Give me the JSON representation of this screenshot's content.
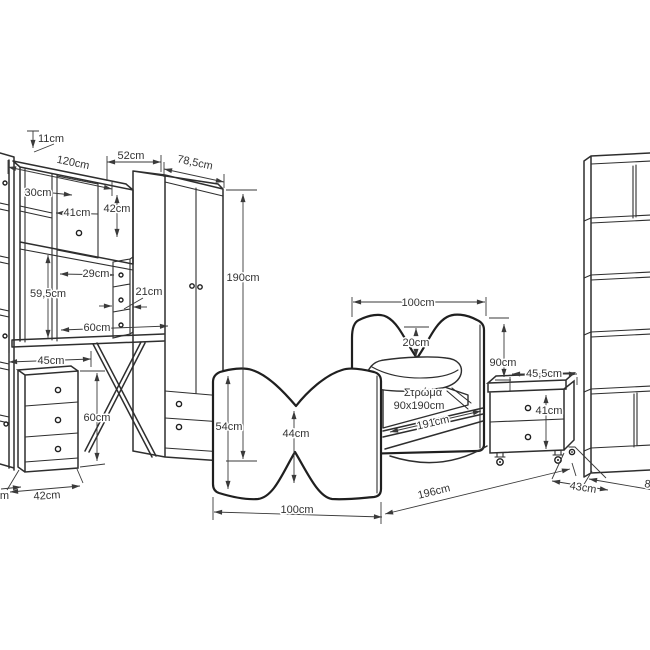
{
  "meta": {
    "background": "#ffffff",
    "line_color": "#2e2e2e",
    "text_color": "#333333"
  },
  "desk": {
    "top_depth": "11cm",
    "width": "120cm",
    "upper_section_width": "52cm",
    "hutch_left_height": "30cm",
    "hutch_door_width": "41cm",
    "hutch_right_height": "42cm",
    "open_shelf_width": "29cm",
    "small_drawers_width": "21cm",
    "open_height": "59,5cm",
    "surface_span": "60cm",
    "knee_span": "45cm",
    "pedestal_height": "60cm",
    "pedestal_width": "42cm",
    "left_edge_partial": "cm"
  },
  "wardrobe": {
    "width": "78,5cm",
    "height": "190cm"
  },
  "bed": {
    "footboard_height": "54cm",
    "footboard_waist": "44cm",
    "footboard_width": "100cm",
    "headboard_width": "100cm",
    "headboard_notch": "20cm",
    "headboard_height": "90cm",
    "mattress_line1": "Στρώμα",
    "mattress_line2": "90x190cm",
    "mattress_length": "191cm",
    "total_length": "196cm"
  },
  "nightstand": {
    "width": "45,5cm",
    "height": "41cm",
    "depth": "43cm"
  },
  "bookshelf": {
    "width": "80cm"
  }
}
